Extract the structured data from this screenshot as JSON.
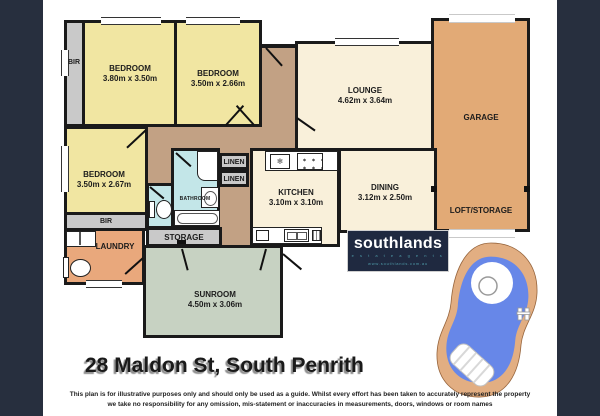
{
  "title": "28 Maldon St, South Penrith",
  "disclaimer": {
    "line1": "This plan is for illustrative purposes only and should only be used as a guide. Whilst every effort has been taken to accurately represent the property",
    "line2": "we take no responsibility for any omission, mis-statement or inaccuracies in measurements, doors, windows or room names"
  },
  "branding": {
    "logo": "southlands",
    "tagline": "e s t a t e   a g e n t s",
    "website": "www.southlands.com.au"
  },
  "rooms": {
    "bedroom1": {
      "name": "BEDROOM",
      "dims": "3.80m x 3.50m"
    },
    "bedroom2": {
      "name": "BEDROOM",
      "dims": "3.50m x 2.66m"
    },
    "bedroom3": {
      "name": "BEDROOM",
      "dims": "3.50m x 2.67m"
    },
    "lounge": {
      "name": "LOUNGE",
      "dims": "4.62m x 3.64m"
    },
    "dining": {
      "name": "DINING",
      "dims": "3.12m x 2.50m"
    },
    "kitchen": {
      "name": "KITCHEN",
      "dims": "3.10m x 3.10m"
    },
    "sunroom": {
      "name": "SUNROOM",
      "dims": "4.50m x 3.06m"
    },
    "garage": {
      "name": "GARAGE"
    },
    "loft_storage": {
      "name": "LOFT/STORAGE"
    },
    "laundry": {
      "name": "LAUNDRY"
    },
    "bathroom": {
      "name": "BATHROOM"
    },
    "storage": {
      "name": "STORAGE"
    },
    "bir_front": {
      "name": "BIR"
    },
    "bir_rear": {
      "name": "BIR"
    },
    "linen_upper": {
      "name": "LINEN"
    },
    "linen_lower": {
      "name": "LINEN"
    }
  },
  "colors": {
    "background": "#272f3e",
    "wall": "#1a1a1a",
    "bedroom_yellow": "#f1e6a2",
    "living_cream": "#f9f0da",
    "hall_tan": "#c2a184",
    "garage_tan": "#e2aa76",
    "laundry_orange": "#e9a87c",
    "sunroom_green": "#c7d2c2",
    "bathroom_blue": "#c3e6e8",
    "robe_gray": "#c9c9c9",
    "pool_water": "#6787e8",
    "pool_deck": "#e2ae82",
    "brand_navy": "#1f2940",
    "brand_teal": "#4e9aa8"
  }
}
